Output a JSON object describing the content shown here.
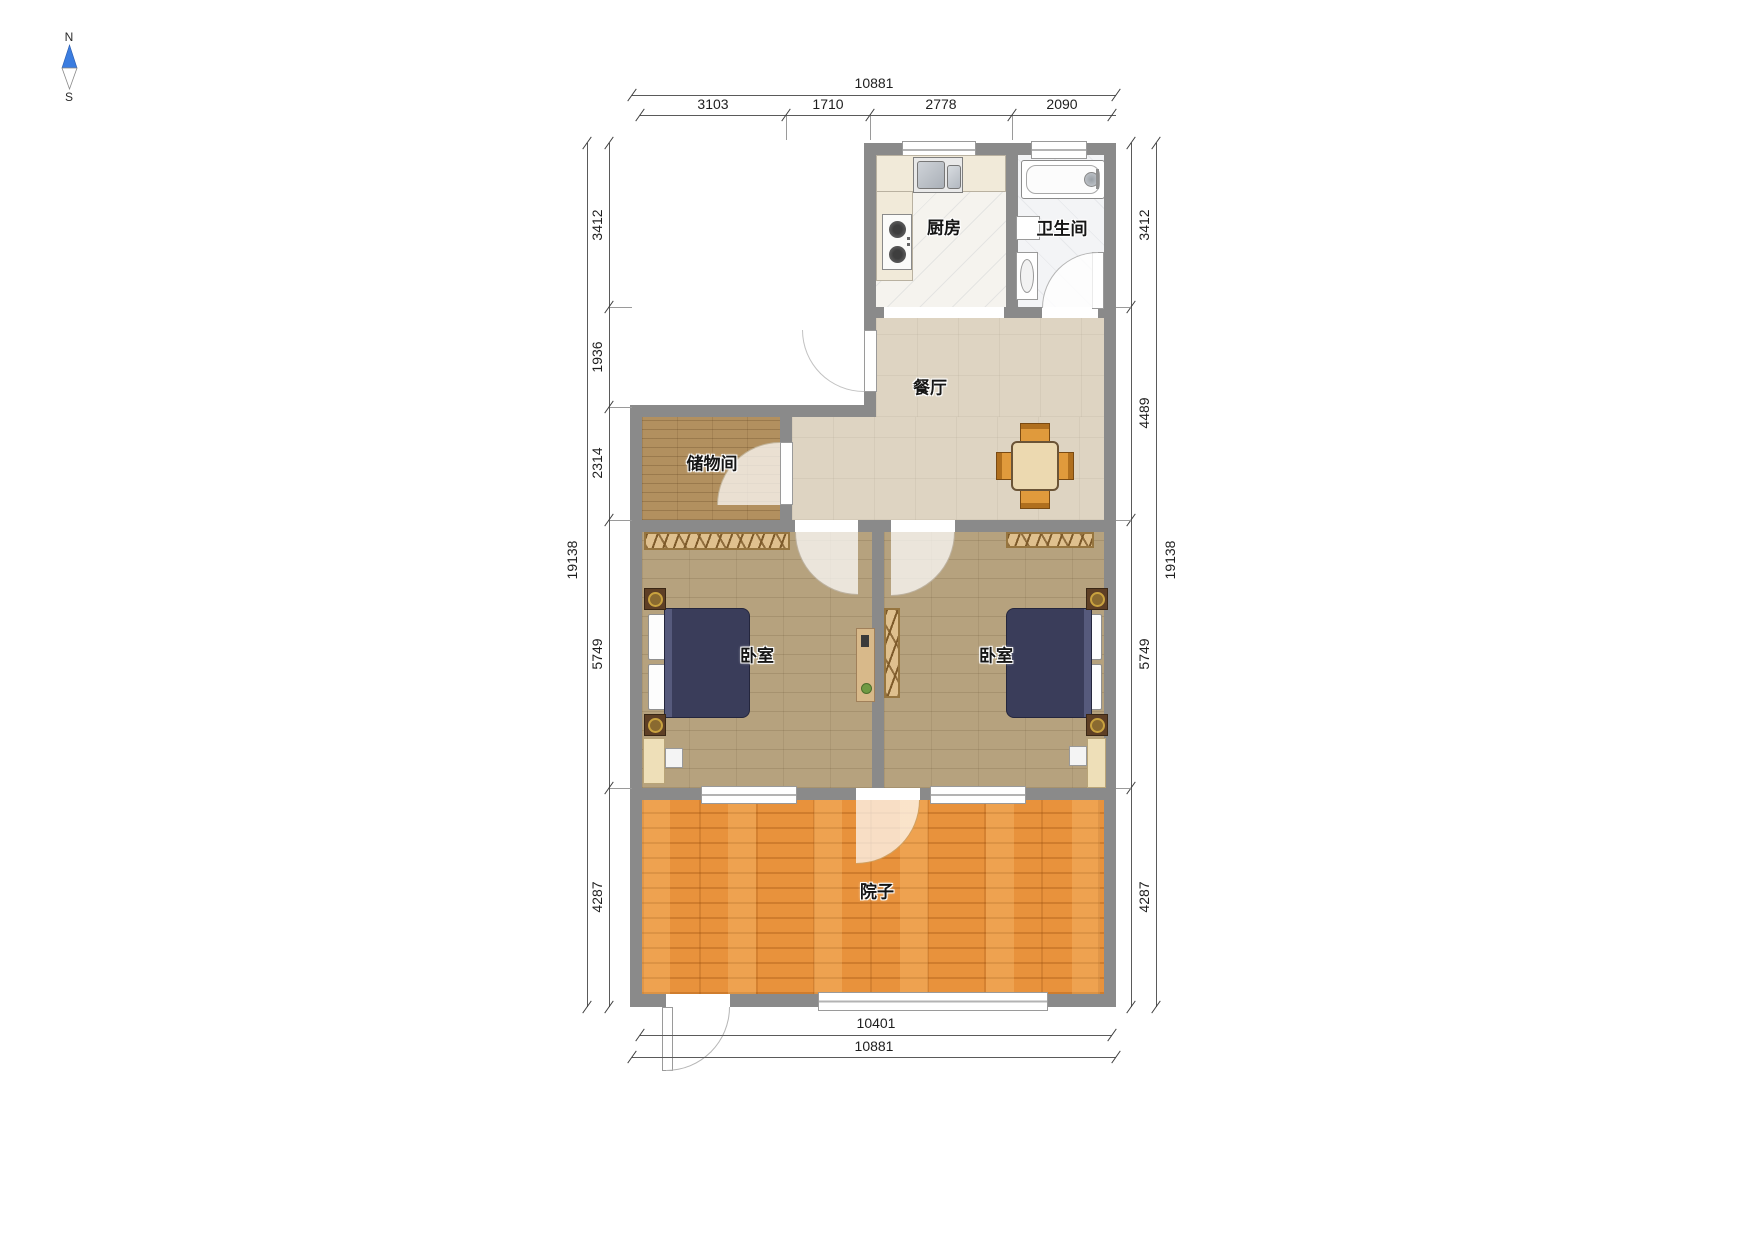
{
  "title": "apartment-floor-plan",
  "compass": {
    "north": "N",
    "south": "S"
  },
  "rooms": {
    "kitchen": "厨房",
    "bathroom": "卫生间",
    "dining": "餐厅",
    "storage": "储物间",
    "bedroom_left": "卧室",
    "bedroom_right": "卧室",
    "courtyard": "院子"
  },
  "dims": {
    "top_total": "10881",
    "top_segments": [
      "3103",
      "1710",
      "2778",
      "2090"
    ],
    "left_total": "19138",
    "left_segments": [
      "3412",
      "1936",
      "2314",
      "5749",
      "4287"
    ],
    "right_total": "19138",
    "right_segments": [
      "3412",
      "4489",
      "5749",
      "4287"
    ],
    "bottom_inner": "10401",
    "bottom_total": "10881"
  },
  "colors": {
    "wall": "#8a8a8a",
    "kitchen_floor": "#f5f3ee",
    "bath_floor": "#f3f4f6",
    "dining_floor": "#ded4c2",
    "storage_floor": "#b2905f",
    "bedroom_floor": "#b6a27e",
    "courtyard_floor": "#e8923c",
    "bed_blanket": "#3a3d5a",
    "wardrobe": "#dfc08e",
    "table_wood": "#e09a3c",
    "compass_north": "#3b7de0"
  }
}
